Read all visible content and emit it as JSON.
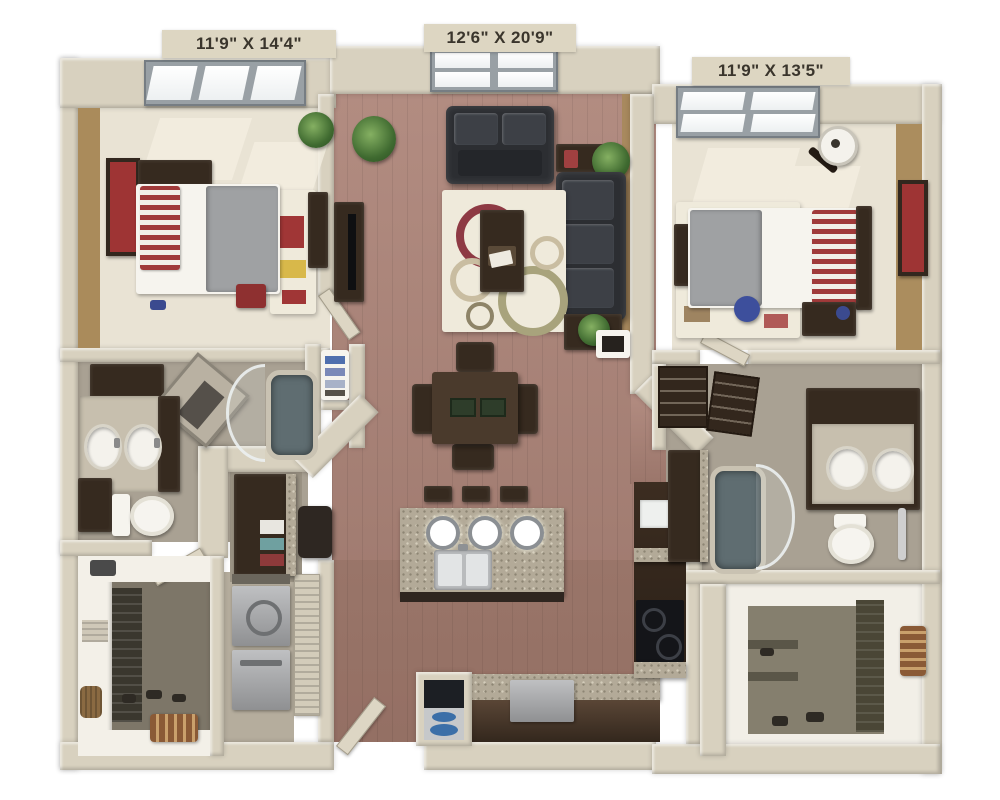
{
  "labels": {
    "bedroom_left": "11'9\" X 14'4\"",
    "living_room": "12'6\" X 20'9\"",
    "bedroom_right": "11'9\" X 13'5\""
  },
  "colors": {
    "background": "#ffffff",
    "wall": "#d8d1bf",
    "accent_wall": "#aa8b5b",
    "carpet": "#e9e3d4",
    "wood_floor": "#a88176",
    "tile_floor": "#a9a193",
    "dark_wood_furniture": "#362a1f",
    "sofa": "#2c2e32",
    "granite_counter": "#b3aa98",
    "accent_red": "#9e3434",
    "plant": "#4a7c3f",
    "bedding": "#f6f4ee",
    "blanket": "#9fa1a3"
  }
}
